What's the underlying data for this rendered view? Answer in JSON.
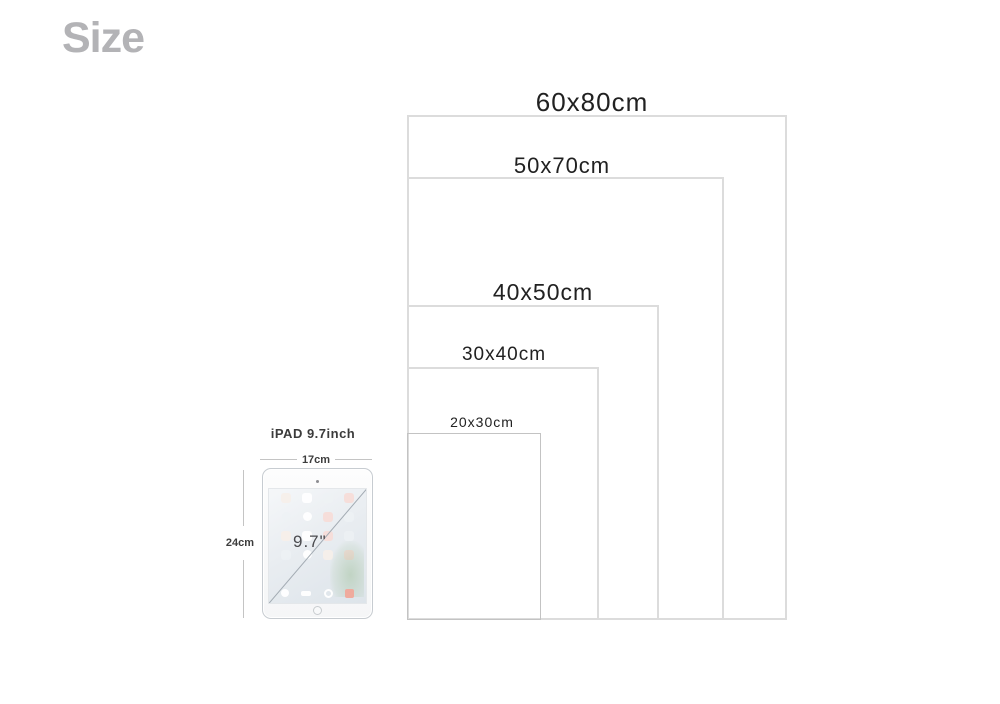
{
  "page": {
    "title": "Size"
  },
  "diagram": {
    "sizes": [
      {
        "label": "60x80cm",
        "width_cm": 60,
        "height_cm": 80
      },
      {
        "label": "50x70cm",
        "width_cm": 50,
        "height_cm": 70
      },
      {
        "label": "40x50cm",
        "width_cm": 40,
        "height_cm": 50
      },
      {
        "label": "30x40cm",
        "width_cm": 30,
        "height_cm": 40
      },
      {
        "label": "20x30cm",
        "width_cm": 20,
        "height_cm": 30
      }
    ],
    "reference_device": {
      "name": "iPAD 9.7inch",
      "width_label": "17cm",
      "height_label": "24cm",
      "screen_diagonal_label": "9.7\""
    }
  },
  "colors": {
    "background": "#ffffff",
    "title_gray": "#b3b3b6",
    "label_text": "#212121",
    "rect_border": "#dcdcdc",
    "small_rect_border": "#c3c3c3",
    "measure_line": "#c4c4c4",
    "ipad_border": "#c7ccd1",
    "dock_red_icon": "#f0a89a"
  }
}
